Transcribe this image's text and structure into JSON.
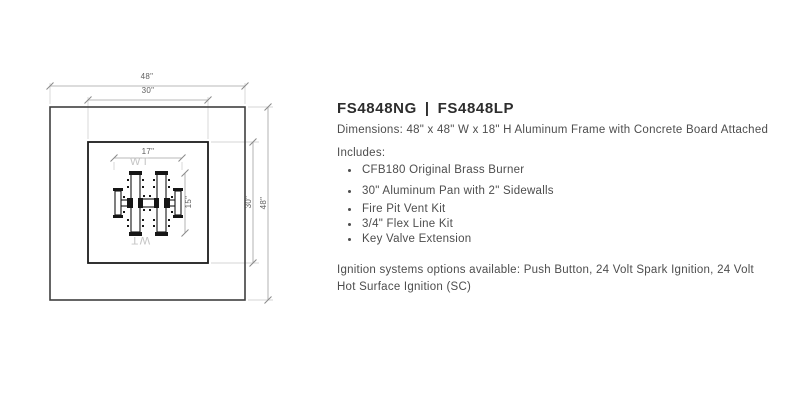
{
  "product": {
    "model_ng": "FS4848NG",
    "separator": "|",
    "model_lp": "FS4848LP",
    "dimensions_line": "Dimensions: 48\" x 48\" W x 18\" H Aluminum Frame with Concrete Board Attached",
    "includes_label": "Includes:",
    "includes_items": [
      "CFB180 Original Brass Burner",
      "30\" Aluminum Pan with 2\" Sidewalls",
      "Fire Pit Vent Kit",
      "3/4\" Flex Line Kit",
      "Key Valve Extension"
    ],
    "ignition_lines": [
      "Ignition systems options available: Push Button, 24 Volt Spark Ignition, 24 Volt",
      "Hot Surface Ignition (SC)"
    ]
  },
  "diagram": {
    "labels": {
      "outer_width": "48\"",
      "pan_width": "30\"",
      "burner_width": "17\"",
      "burner_height": "15\"",
      "pan_height": "30\"",
      "outer_height": "48\"",
      "watermark": "WT"
    }
  },
  "theme": {
    "page_bg": "#ffffff",
    "text_color": "#4d4d4d",
    "title_color": "#2d2d2d",
    "frame_line": "#3f3f3f",
    "pan_line": "#1c1c1c",
    "dim_line": "#a0a0a0",
    "dim_tick": "#8a8a8a",
    "ext_line": "#c9c9c9",
    "dim_text": "#5f5f5f",
    "burner_line": "#161616",
    "watermark": "#c4c4c4"
  }
}
